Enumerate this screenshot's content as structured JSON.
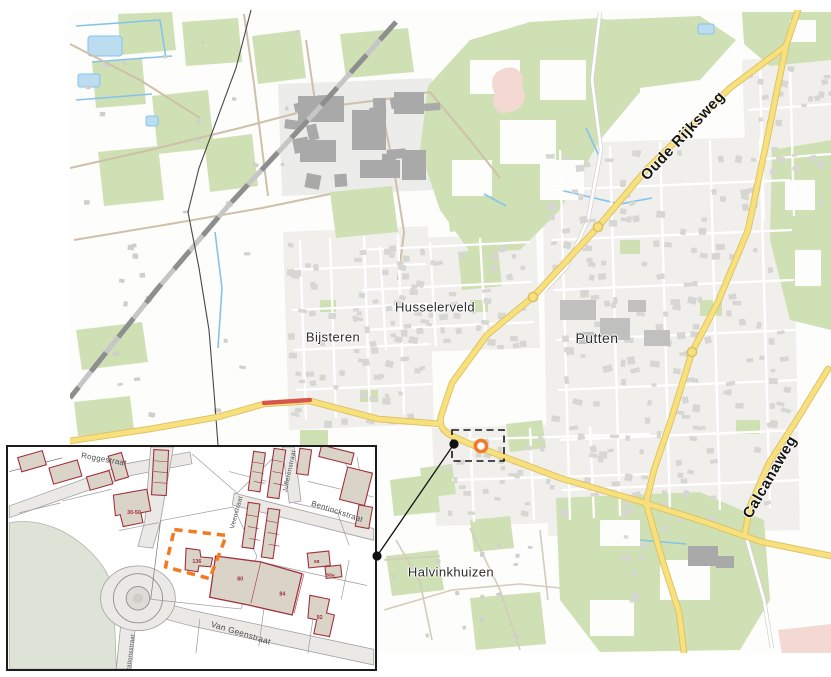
{
  "figure": {
    "kind": "topographic map of Putten with cadastral inset and site marker"
  },
  "colors": {
    "green": "#cfe0b4",
    "pink": "#f4d9d2",
    "water": "#85c3ea",
    "water-fill": "#bcdcf0",
    "yellow": "#f8e07c",
    "yellow-casing": "#dbc063",
    "urban": "#f0efec",
    "building": "#d6d6d3",
    "building-dark": "#a9a9a9",
    "rail": "#c6c6c6",
    "rail-dash": "#8e8e8e",
    "boundary": "#474747",
    "rural-road": "#cfc0aa",
    "roadworks-red": "#d9534f",
    "marker-orange": "#f07c2e",
    "leader": "#111111",
    "inset-bldg": "#d9d3c8",
    "inset-red": "#a0303a",
    "inset-pave": "#ebe9e5",
    "inset-sage": "#dde3d7"
  },
  "main_map": {
    "town_labels": [
      {
        "text": "Husselerveld",
        "x": 435,
        "y": 307,
        "size": 13
      },
      {
        "text": "Bijsteren",
        "x": 333,
        "y": 337,
        "size": 13
      },
      {
        "text": "Putten",
        "x": 597,
        "y": 338,
        "size": 14
      },
      {
        "text": "Halvinkhuizen",
        "x": 451,
        "y": 572,
        "size": 13
      }
    ],
    "road_labels": [
      {
        "text": "Oude Rijksweg",
        "x": 683,
        "y": 136,
        "rot": -47,
        "size": 15
      },
      {
        "text": "Calcanaweg",
        "x": 770,
        "y": 477,
        "rot": -60,
        "size": 15
      }
    ],
    "marker": {
      "x": 481,
      "y": 446
    }
  },
  "inset": {
    "street_labels": [
      {
        "text": "Roggestraat",
        "x": 102,
        "y": 460,
        "rot": 10,
        "size": 8
      },
      {
        "text": "Bentinckstraat",
        "x": 339,
        "y": 513,
        "rot": 18,
        "size": 8
      },
      {
        "text": "Van Geenstraat",
        "x": 241,
        "y": 637,
        "rot": 17,
        "size": 8.5
      },
      {
        "text": "Jufferenstraat",
        "x": 293,
        "y": 470,
        "rot": -78,
        "size": 6.5
      },
      {
        "text": "Veenstraat",
        "x": 239,
        "y": 512,
        "rot": -75,
        "size": 6.5
      },
      {
        "text": "Stationsstraat",
        "x": 131,
        "y": 656,
        "rot": -83,
        "size": 6
      }
    ],
    "parcel_labels": [
      {
        "text": "30-50",
        "x": 133,
        "y": 513,
        "size": 5.5
      },
      {
        "text": "136",
        "x": 197,
        "y": 563,
        "size": 5.5
      },
      {
        "text": "80",
        "x": 241,
        "y": 581,
        "size": 5.5
      },
      {
        "text": "84",
        "x": 284,
        "y": 596,
        "size": 5.5
      },
      {
        "text": "92",
        "x": 322,
        "y": 620,
        "size": 5.5
      },
      {
        "text": "58",
        "x": 319,
        "y": 563,
        "size": 5
      },
      {
        "text": "58a",
        "x": 333,
        "y": 577,
        "size": 5
      }
    ]
  }
}
